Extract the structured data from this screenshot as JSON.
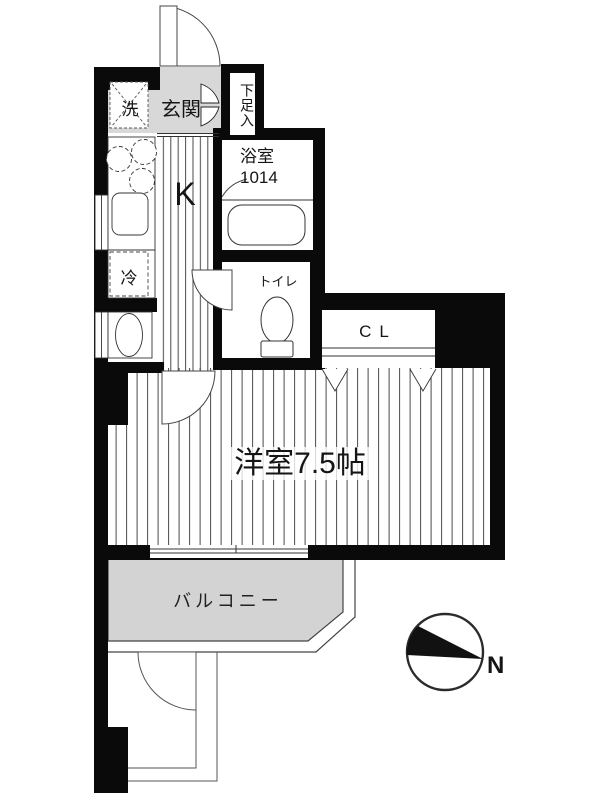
{
  "title": "1K apartment floor plan",
  "rooms": {
    "washer": "洗",
    "entrance": "玄関",
    "shoe_cabinet": "下足入",
    "kitchen": "K",
    "bathroom": {
      "name": "浴室",
      "size": "1014"
    },
    "refrigerator": "冷",
    "toilet": "トイレ",
    "closet": "CL",
    "main_room": "洋室7.5帖",
    "balcony": "バルコニー"
  },
  "compass": {
    "north_label": "N"
  },
  "colors": {
    "wall": "#0a0a0a",
    "entrance_floor": "#d8d8d8",
    "balcony_floor": "#d3d3d3",
    "floor_line": "#4a4a4a",
    "background": "#ffffff"
  }
}
